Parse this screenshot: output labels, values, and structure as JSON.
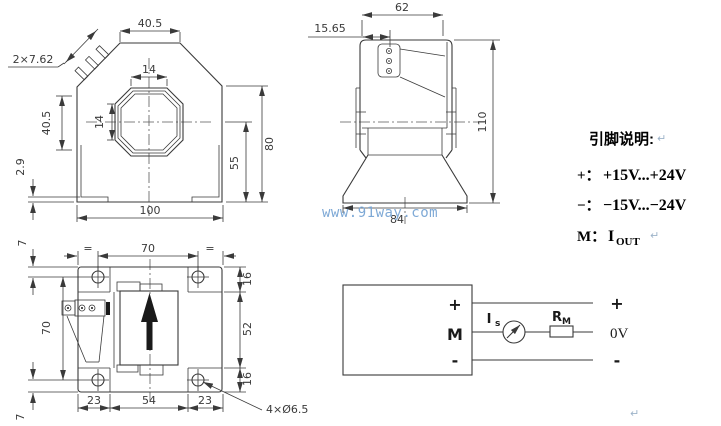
{
  "watermark": "www.91way.com",
  "paragraph_mark": "↵",
  "colors": {
    "line": "#3a3a3a",
    "dim_text": "#3a3a3a",
    "watermark": "#7ea9d6",
    "annotation_text": "#000000",
    "paragraph_mark": "#9db3c9",
    "arrow_fill": "#1a1a1a"
  },
  "front_view": {
    "dim_top_width": "40.5",
    "dim_pins": "2×7.62",
    "dim_hole_width": "14",
    "dim_hole_height": "14",
    "dim_left_height": "40.5",
    "dim_foot": "2.9",
    "dim_bottom_width": "100",
    "dim_total_height": "80",
    "dim_inner_height": "55"
  },
  "side_view": {
    "dim_top_width": "62",
    "dim_pin_offset": "15.65",
    "dim_total_height": "110",
    "dim_base_width": "84"
  },
  "plan_view": {
    "dim_edge_to_hole_top": "7",
    "dim_hole_span": "70",
    "eq_left": "=",
    "eq_right": "=",
    "dim_hole_span_vertical": "70",
    "dim_tab_top": "16",
    "dim_body_height": "52",
    "dim_tab_bottom": "16",
    "dim_foot_left": "23",
    "dim_center_width": "54",
    "dim_foot_right": "23",
    "dim_edge_to_hole_bottom": "7",
    "dim_mounting_holes": "4×Ø6.5"
  },
  "pin_description": {
    "title": "引脚说明:",
    "lines": [
      {
        "pin": "+：",
        "value": "+15V...+24V"
      },
      {
        "pin": "−：",
        "value": "−15V...−24V"
      },
      {
        "pin": "M：",
        "value": "I",
        "sub": "OUT"
      }
    ]
  },
  "circuit": {
    "terminal_plus": "+",
    "terminal_m": "M",
    "terminal_minus": "-",
    "out_plus": "+",
    "out_zero": "0V",
    "out_minus": "-",
    "current_label": "I",
    "current_sub": "s",
    "resistor_label": "R",
    "resistor_sub": "M"
  }
}
